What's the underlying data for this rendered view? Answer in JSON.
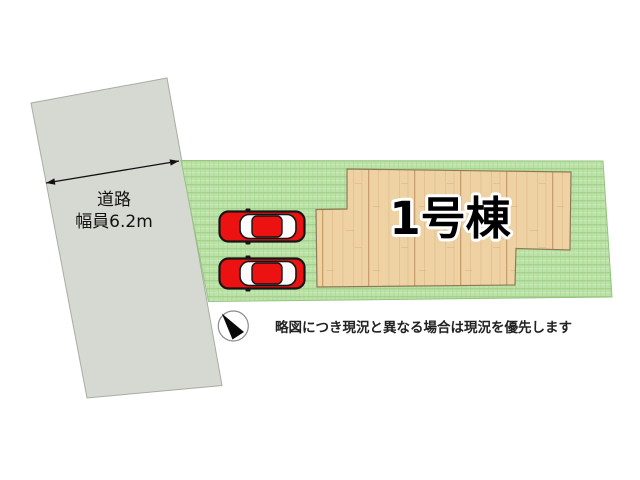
{
  "diagram": {
    "road": {
      "name_line1": "道路",
      "width_line2": "幅員6.2m"
    },
    "building": {
      "label": "1号棟"
    },
    "parking": {
      "car_count": 2
    },
    "note": "略図につき現況と異なる場合は現況を優先します",
    "colors": {
      "road_fill": "#d6d9d1",
      "grass_base": "#bce2a8",
      "wood_base": "#eed2a4",
      "car_body": "#ec1212",
      "car_window": "#fbfbfb"
    }
  }
}
